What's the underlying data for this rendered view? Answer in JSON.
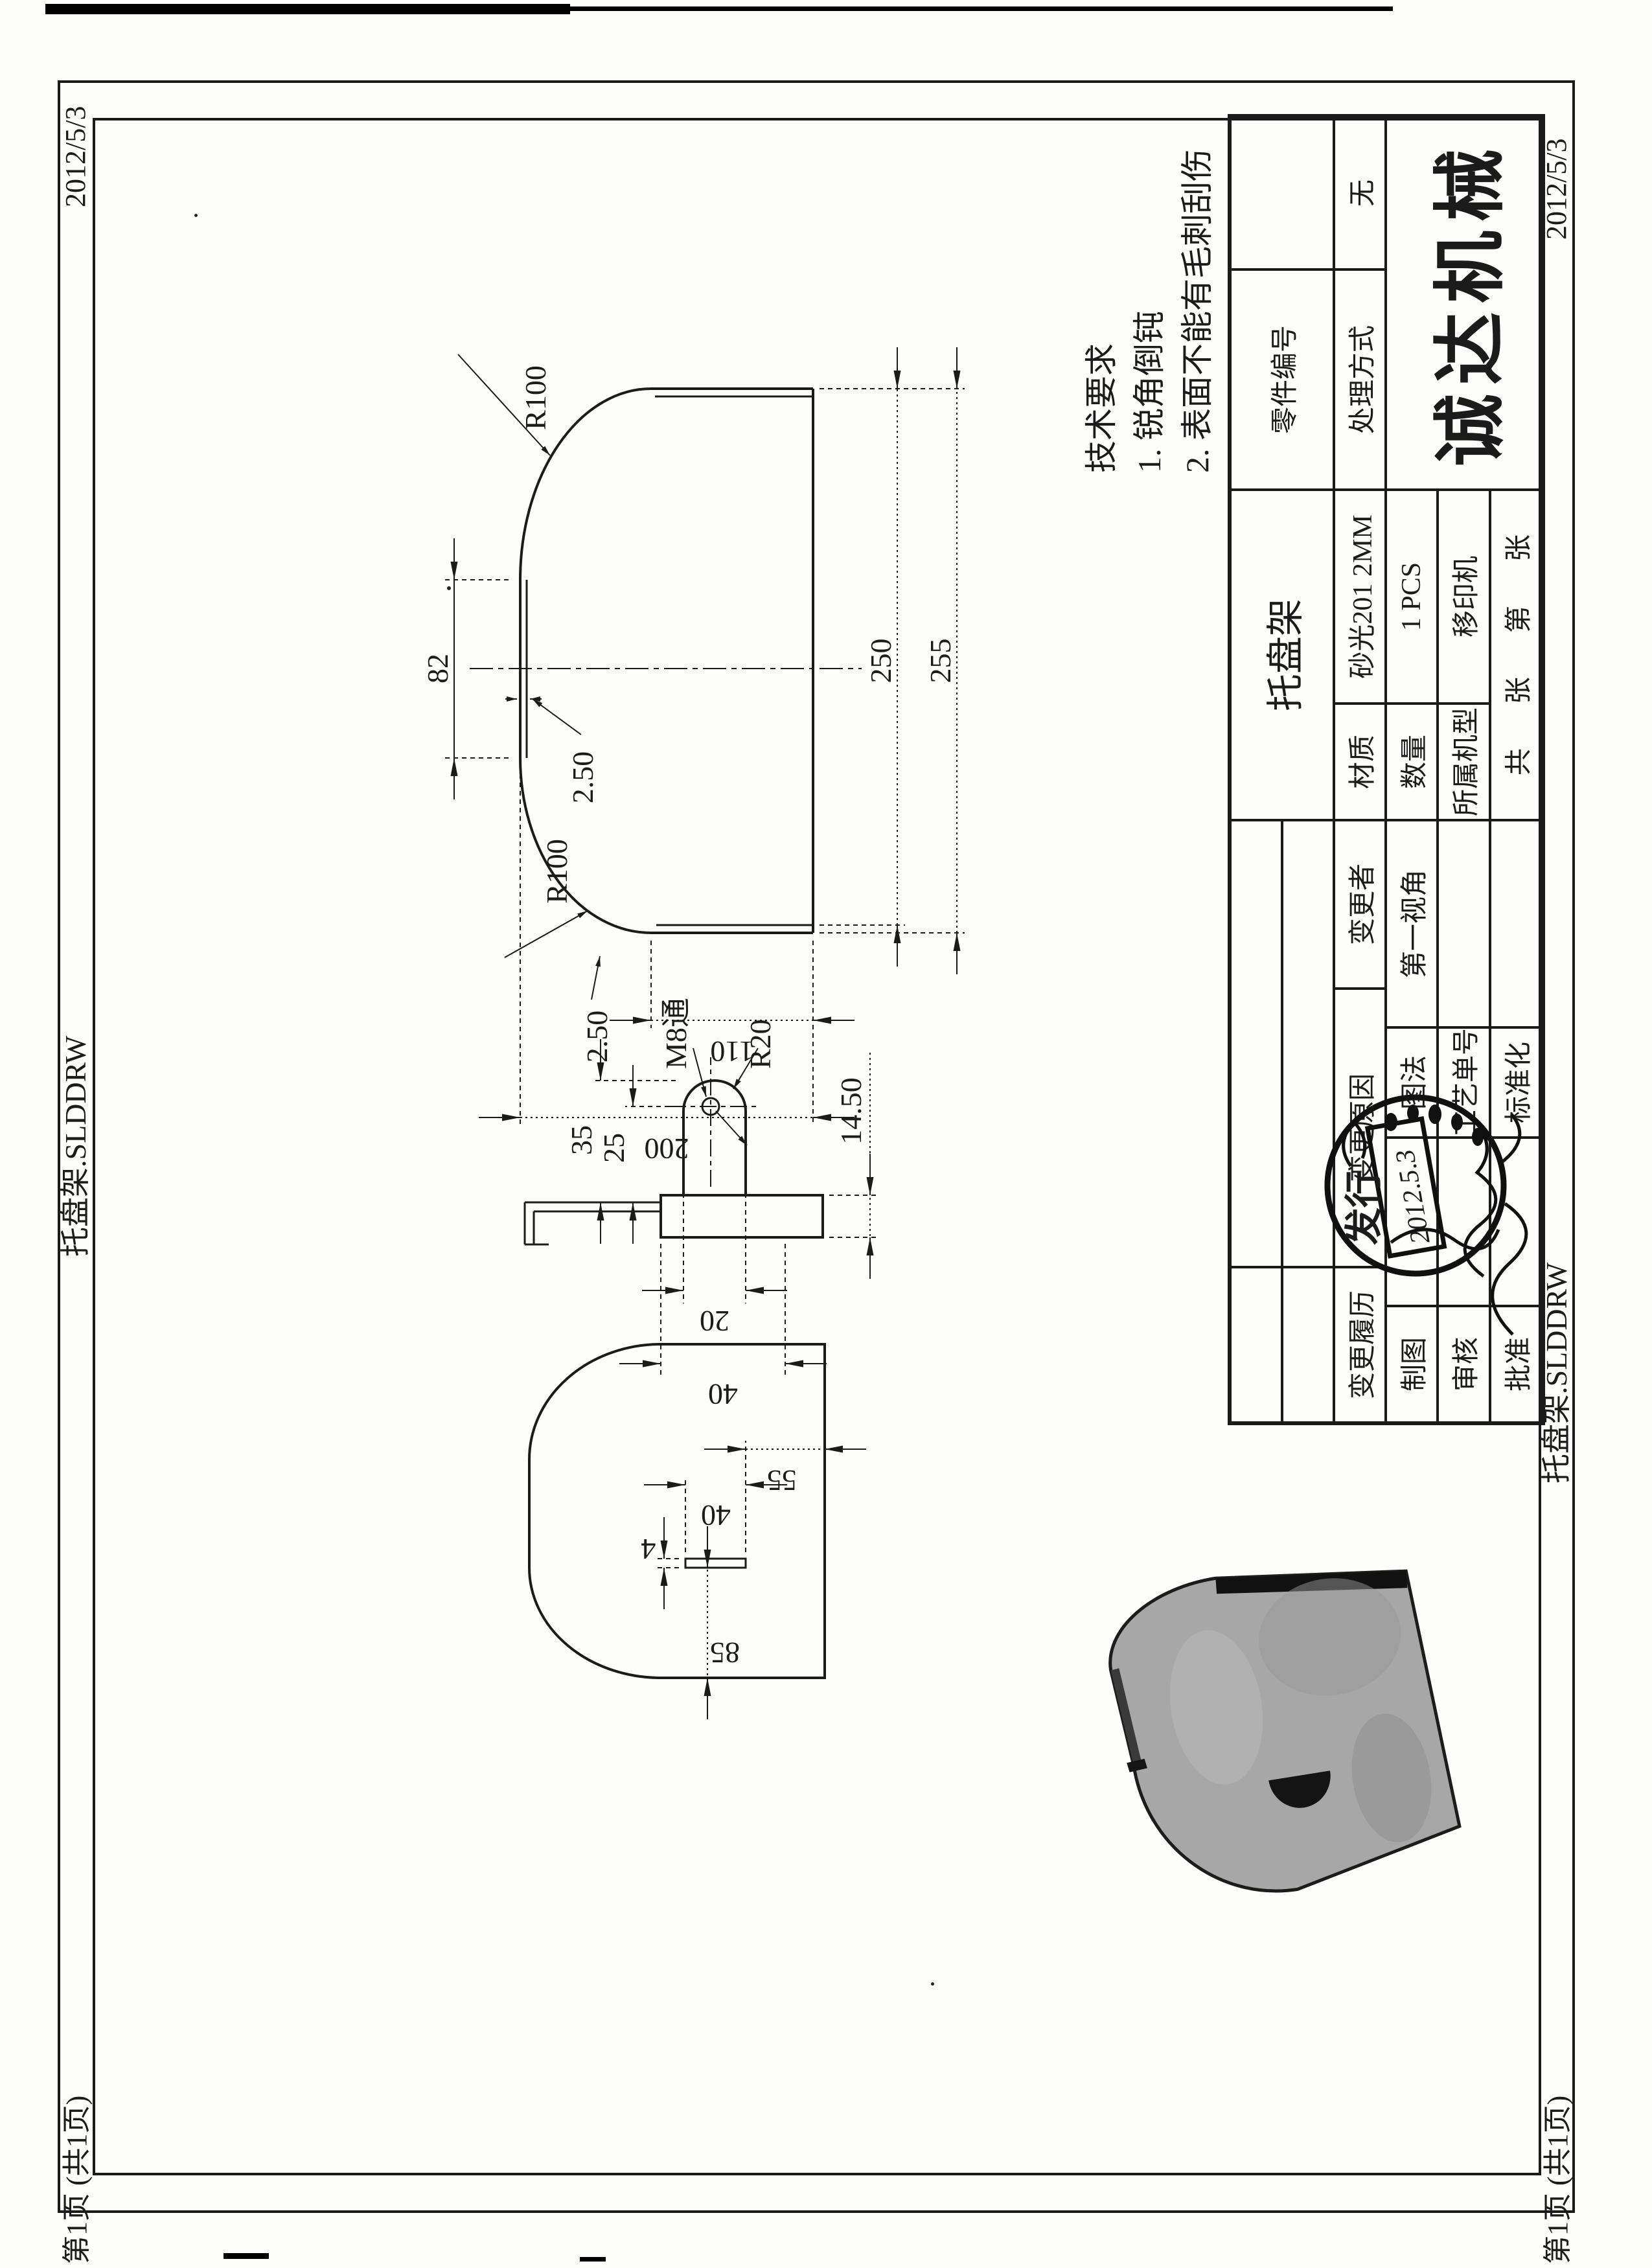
{
  "meta": {
    "date": "2012/5/3",
    "file": "托盘架.SLDDRW",
    "sheet": "第1页 (共1页)"
  },
  "tech": {
    "title": "技术要求",
    "item1": "1. 锐角倒钝",
    "item2": "2. 表面不能有毛刺刮伤"
  },
  "tb": {
    "company": "诚达机械",
    "part_name": "托盘架",
    "part_no_label": "零件编号",
    "part_no_value": "",
    "treatment_label": "处理方式",
    "treatment_value": "无",
    "material_label": "材质",
    "material_value": "砂光201 2MM",
    "qty_label": "数量",
    "qty_value": "1 PCS",
    "machine_label": "所属机型",
    "machine_value": "移印机",
    "sheet": {
      "total": "共",
      "unit_a": "张",
      "index": "第",
      "unit_b": "张"
    },
    "rev_history": "变更履历",
    "rev_reason": "变更原因",
    "rev_by": "变更者",
    "projection": "第一视角",
    "method": "图法",
    "process_no": "工艺单号",
    "standard": "标准化",
    "drawn": "制图",
    "checked": "审核",
    "approved": "批准",
    "stamp": {
      "text": "发行",
      "date": "2012.5.3"
    }
  },
  "dims": {
    "front": {
      "neck": "82",
      "flange_top": "2.50",
      "flange_left": "2.50",
      "r_top": "R100",
      "r_bottom": "R100",
      "inner": "250",
      "total": "255",
      "side": "110",
      "height": "200"
    },
    "side": {
      "len": "35",
      "to_hole": "25",
      "hole": "M8通",
      "radius": "R20",
      "depth": "14.50",
      "tab": "20",
      "tab_total": "40"
    },
    "flat": {
      "edge": "55",
      "slot_len": "40",
      "slot_w": "4",
      "offset": "85"
    }
  },
  "colors": {
    "ink": "#1b1b1b",
    "paper": "#fdfdfb",
    "photo_gray": "#a7a7a7"
  }
}
